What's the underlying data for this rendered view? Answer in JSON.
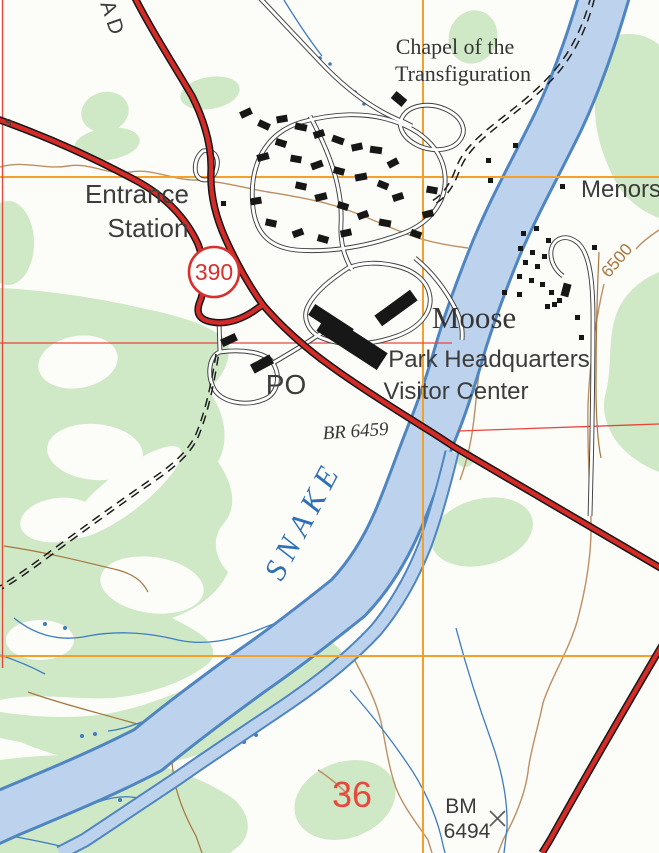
{
  "map": {
    "labels": {
      "road_partial": "OAD",
      "left_edge_partial": "s",
      "entrance1": "Entrance",
      "entrance2": "Station",
      "shield": "390",
      "chapel1": "Chapel of the",
      "chapel2": "Transfiguration",
      "menors": "Menors",
      "moose": "Moose",
      "hq1": "Park Headquarters",
      "hq2": "Visitor Center",
      "po": "PO",
      "bridge": "BR 6459",
      "river": "SNAKE",
      "contour_elev": "6500",
      "section_number": "36",
      "bm1": "BM",
      "bm2": "6494"
    },
    "colors": {
      "background": "#fcfcf9",
      "vegetation": "#cfe8c5",
      "river_fill": "#bdd3ed",
      "river_edge": "#4f86c2",
      "stream_blue": "#3d7cc0",
      "road_red": "#d32b27",
      "road_casing": "#161616",
      "section_line_red": "#e8453c",
      "grid_orange": "#f6a02c",
      "contour_brown": "#bd8f62",
      "trail_brown": "#a5773f",
      "building": "#171717",
      "label_dark": "#3c3c3c",
      "serif_dark": "#353535",
      "water_label": "#2f6fb5",
      "red_label": "#e8483c",
      "shield_red": "#d8302c"
    }
  }
}
